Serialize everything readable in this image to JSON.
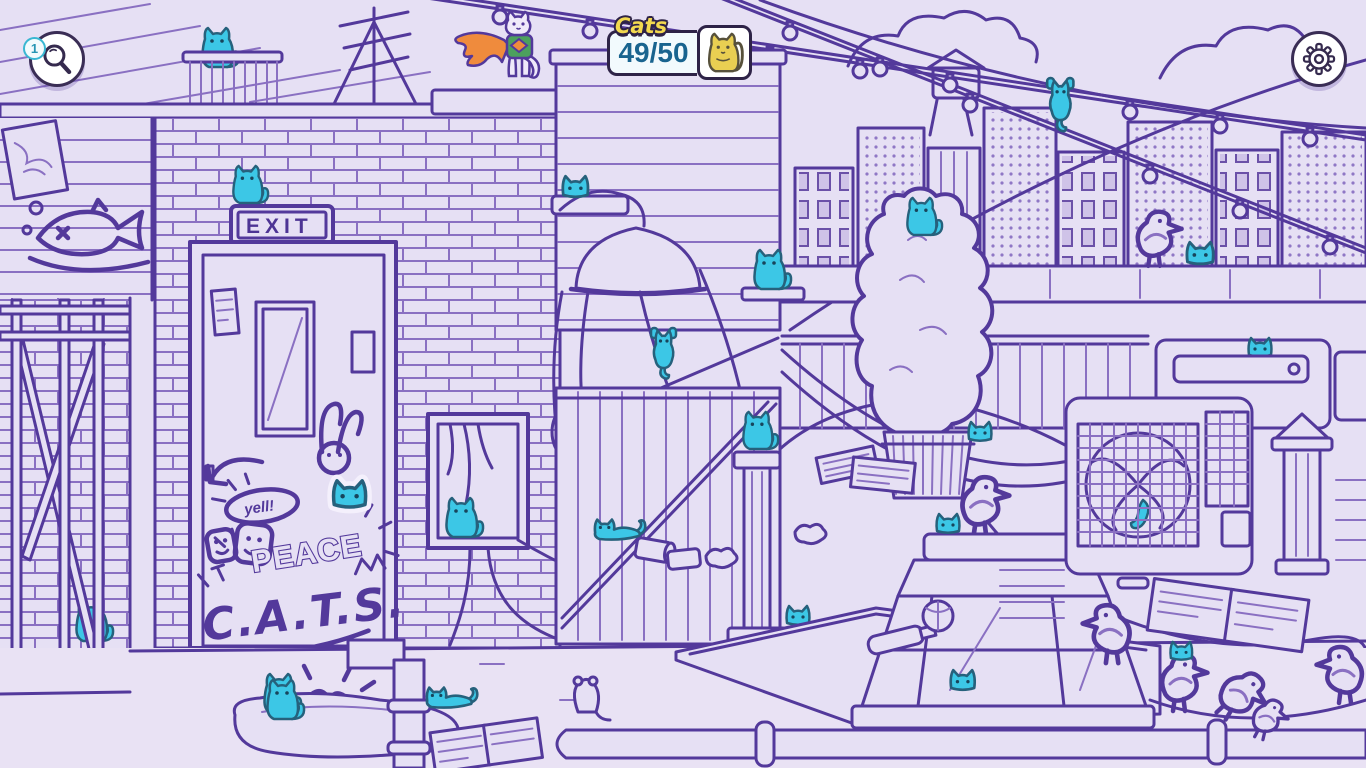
{
  "ui": {
    "hint": {
      "badge_count": "1",
      "icon": "magnifier-icon"
    },
    "cat_counter": {
      "label": "Cats",
      "count": "49/50",
      "found": 49,
      "total": 50,
      "icon": "yellow-cat-icon"
    },
    "settings": {
      "icon": "gear-icon"
    }
  },
  "scene": {
    "exit_sign": "EXIT",
    "graffiti_yell": "yell!",
    "graffiti_peace": "PEACE",
    "graffiti_cats": "C.A.T.S."
  },
  "colors": {
    "background": "#e6e0f4",
    "line_ink": "#53399b",
    "hidden_cat": "#3cc7e6",
    "counter_text": "#19648f",
    "counter_label_yellow": "#f2d94f",
    "hint_badge_teal": "#39b7d2",
    "superhero_cape_orange": "#ef8b3d",
    "superhero_shirt_green": "#4ca05e",
    "counter_cat_yellow": "#e9cf52"
  }
}
